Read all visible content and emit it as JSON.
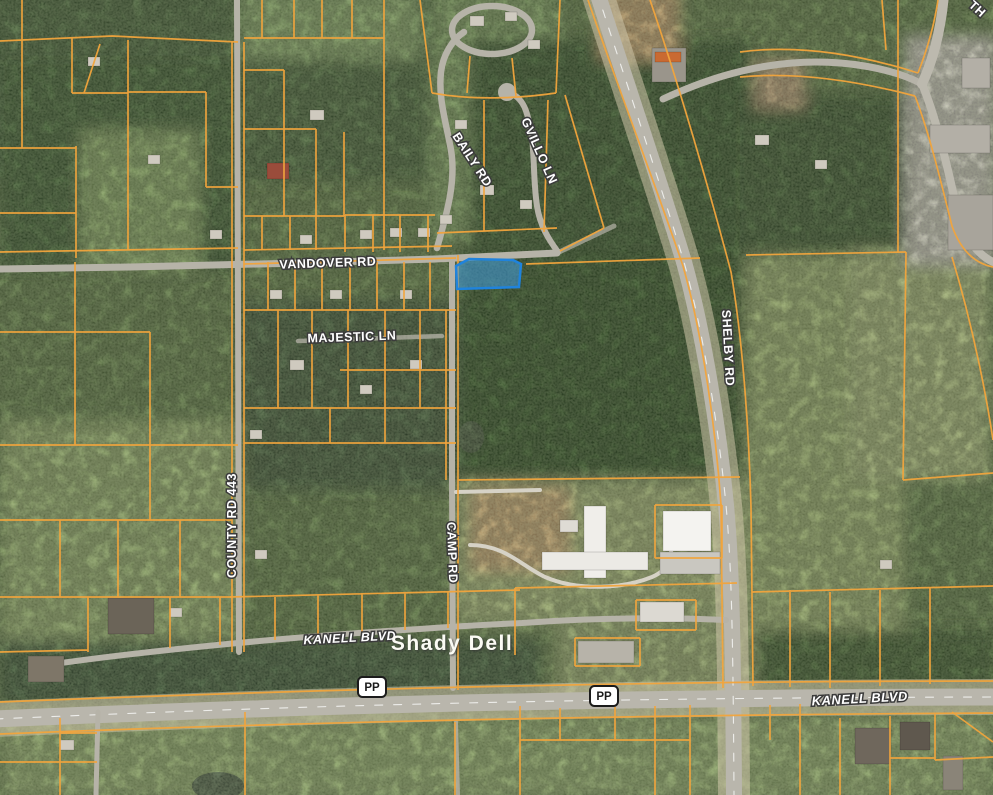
{
  "map": {
    "view": "satellite-parcel-view",
    "colors": {
      "parcel_line": "#f1a43c",
      "selected_parcel_fill": "#3f9ce0",
      "selected_parcel_border": "#1f83dd"
    },
    "road_labels": [
      {
        "id": "vandover",
        "text": "VANDOVER RD"
      },
      {
        "id": "majestic",
        "text": "MAJESTIC LN"
      },
      {
        "id": "baily",
        "text": "BAILY RD"
      },
      {
        "id": "gvillo",
        "text": "GVILLO LN"
      },
      {
        "id": "county443",
        "text": "COUNTY RD 443"
      },
      {
        "id": "camp",
        "text": "CAMP RD"
      },
      {
        "id": "shelby",
        "text": "SHELBY RD"
      },
      {
        "id": "kanell_west",
        "text": "KANELL BLVD"
      },
      {
        "id": "kanell_east",
        "text": "KANELL BLVD"
      },
      {
        "id": "partial_top_right",
        "text": "TH"
      }
    ],
    "place_labels": [
      {
        "id": "shady_dell",
        "text": "Shady Dell"
      }
    ],
    "route_shields": [
      {
        "id": "pp_west",
        "text": "PP"
      },
      {
        "id": "pp_east",
        "text": "PP"
      }
    ]
  }
}
